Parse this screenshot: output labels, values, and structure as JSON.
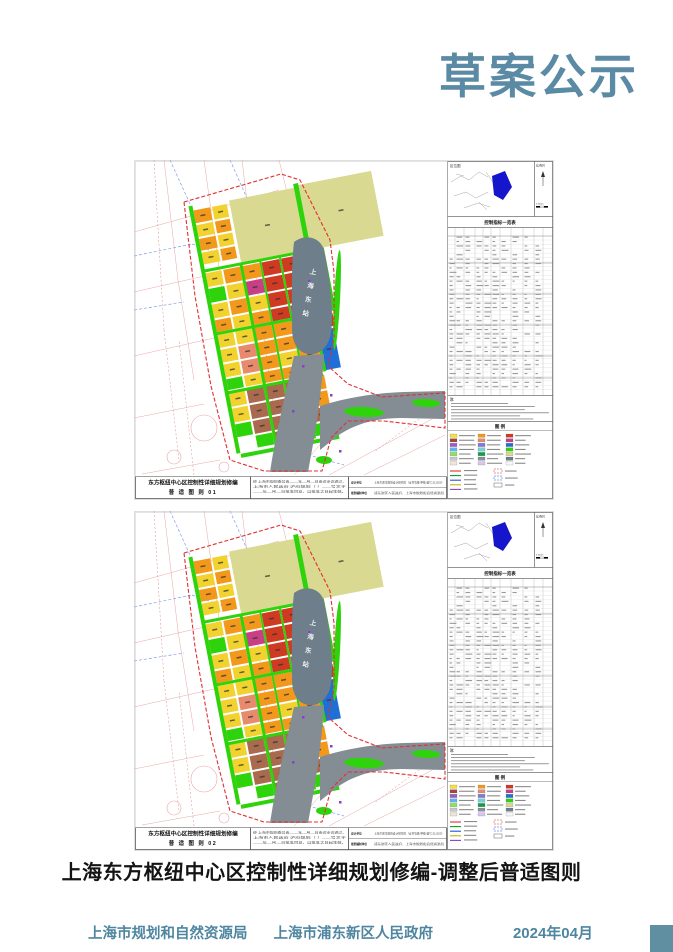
{
  "header": {
    "title": "草案公示",
    "accent_color": "#5b8ba4"
  },
  "caption": {
    "text": "上海东方枢纽中心区控制性详细规划修编-调整后普适图则"
  },
  "footer": {
    "agency_left": "上海市规划和自然资源局",
    "agency_right": "上海市浦东新区人民政府",
    "date": "2024年04月",
    "text_color": "#4e86a0",
    "square_color": "#5f8fa1"
  },
  "sheets": [
    {
      "number": "01"
    },
    {
      "number": "02"
    }
  ],
  "sheet": {
    "map_title": "东方枢纽中心区控制性详细规划修编",
    "sheet_type": "普 适 图 则",
    "station_label": "上海东站",
    "locator_label": "区位图",
    "scale_label": "比例尺",
    "scale_marks": "0  200m",
    "table_title": "控制指标一览表",
    "notes_label": "注:",
    "legend_title": "图 例",
    "approval_lines": [
      "经 上海市规划委员会____年__月__日会议审议通过，",
      "上海市人民政府 沪府规划〔 〕___号文于",
      "____年__月__日批准同意，自批准之日起生效。"
    ],
    "design_rows": [
      {
        "label": "设计单位",
        "text": "上海市城市规划设计研究院（证书等级:甲级 编号:211020）"
      },
      {
        "label": "规划编制单位",
        "text": "浦东新区人民政府、上海市规划和自然资源局"
      }
    ],
    "palette": {
      "Y": "#f2d22e",
      "O": "#f2991c",
      "R": "#cf3a23",
      "S": "#e88a6c",
      "B": "#a96a4d",
      "G": "#2fd30b",
      "L": "#d9d992",
      "U": "#1f6fd6",
      "M": "#c93f85",
      "station": "#6e7e8a",
      "corridor": "#848d94",
      "boundary": "#e03030",
      "bg_road": "#eaa5a5",
      "bg_water": "#7f9fe8",
      "locator_area": "#1515cc",
      "metro": "#8a3fc6"
    },
    "parcels": [
      [
        96,
        30,
        66,
        63,
        "L"
      ],
      [
        167,
        28,
        74,
        66,
        "L"
      ],
      [
        59,
        33,
        17,
        13,
        "O"
      ],
      [
        78,
        33,
        15,
        13,
        "Y"
      ],
      [
        59,
        48,
        17,
        12,
        "Y"
      ],
      [
        78,
        48,
        15,
        12,
        "O"
      ],
      [
        59,
        62,
        17,
        12,
        "O"
      ],
      [
        78,
        62,
        15,
        12,
        "Y"
      ],
      [
        59,
        76,
        17,
        12,
        "Y"
      ],
      [
        78,
        76,
        15,
        12,
        "O"
      ],
      [
        59,
        97,
        16,
        14,
        "Y"
      ],
      [
        77,
        97,
        17,
        14,
        "O"
      ],
      [
        96,
        97,
        18,
        14,
        "O"
      ],
      [
        116,
        97,
        18,
        14,
        "R"
      ],
      [
        136,
        97,
        20,
        14,
        "R"
      ],
      [
        158,
        97,
        18,
        14,
        "R"
      ],
      [
        59,
        113,
        16,
        14,
        "G"
      ],
      [
        77,
        113,
        17,
        14,
        "Y"
      ],
      [
        96,
        113,
        18,
        14,
        "M"
      ],
      [
        116,
        113,
        18,
        14,
        "R"
      ],
      [
        136,
        113,
        20,
        14,
        "R"
      ],
      [
        158,
        113,
        18,
        14,
        "R"
      ],
      [
        59,
        129,
        16,
        14,
        "Y"
      ],
      [
        77,
        129,
        17,
        14,
        "O"
      ],
      [
        96,
        129,
        18,
        14,
        "Y"
      ],
      [
        116,
        129,
        18,
        14,
        "R"
      ],
      [
        136,
        129,
        20,
        14,
        "R"
      ],
      [
        158,
        129,
        18,
        14,
        "R"
      ],
      [
        59,
        145,
        16,
        12,
        "O"
      ],
      [
        77,
        145,
        17,
        12,
        "Y"
      ],
      [
        96,
        145,
        18,
        12,
        "O"
      ],
      [
        116,
        145,
        18,
        12,
        "R"
      ],
      [
        136,
        145,
        20,
        12,
        "M"
      ],
      [
        59,
        160,
        16,
        13,
        "Y"
      ],
      [
        77,
        160,
        17,
        13,
        "Y"
      ],
      [
        96,
        160,
        18,
        13,
        "O"
      ],
      [
        116,
        160,
        18,
        13,
        "O"
      ],
      [
        136,
        160,
        20,
        13,
        "R"
      ],
      [
        158,
        160,
        18,
        13,
        "R"
      ],
      [
        59,
        175,
        16,
        13,
        "Y"
      ],
      [
        77,
        175,
        17,
        13,
        "S"
      ],
      [
        96,
        175,
        18,
        13,
        "O"
      ],
      [
        116,
        175,
        18,
        13,
        "O"
      ],
      [
        136,
        175,
        20,
        13,
        "O"
      ],
      [
        158,
        175,
        16,
        40,
        "U"
      ],
      [
        59,
        190,
        16,
        13,
        "Y"
      ],
      [
        77,
        190,
        17,
        13,
        "S"
      ],
      [
        96,
        190,
        18,
        13,
        "O"
      ],
      [
        116,
        190,
        18,
        13,
        "Y"
      ],
      [
        136,
        190,
        20,
        13,
        "O"
      ],
      [
        59,
        205,
        16,
        11,
        "G"
      ],
      [
        77,
        205,
        17,
        11,
        "Y"
      ],
      [
        96,
        205,
        18,
        11,
        "O"
      ],
      [
        116,
        205,
        18,
        11,
        "O"
      ],
      [
        136,
        205,
        20,
        11,
        "O"
      ],
      [
        59,
        219,
        16,
        14,
        "Y"
      ],
      [
        77,
        219,
        17,
        14,
        "B"
      ],
      [
        96,
        219,
        18,
        14,
        "B"
      ],
      [
        116,
        219,
        18,
        14,
        "B"
      ],
      [
        136,
        219,
        20,
        14,
        "O"
      ],
      [
        59,
        235,
        16,
        14,
        "Y"
      ],
      [
        77,
        235,
        17,
        14,
        "B"
      ],
      [
        96,
        235,
        18,
        14,
        "B"
      ],
      [
        116,
        235,
        18,
        14,
        "B"
      ],
      [
        136,
        235,
        20,
        14,
        "O"
      ],
      [
        59,
        251,
        16,
        13,
        "G"
      ],
      [
        77,
        251,
        17,
        13,
        "B"
      ],
      [
        96,
        251,
        18,
        13,
        "B"
      ],
      [
        116,
        251,
        18,
        13,
        "Y"
      ],
      [
        136,
        251,
        20,
        13,
        "B"
      ],
      [
        77,
        266,
        17,
        12,
        "G"
      ],
      [
        96,
        266,
        18,
        12,
        "B"
      ],
      [
        116,
        266,
        18,
        12,
        "G"
      ],
      [
        136,
        266,
        20,
        12,
        "G"
      ],
      [
        55,
        28,
        4,
        252,
        "G"
      ],
      [
        94,
        94,
        3,
        186,
        "G"
      ],
      [
        114,
        94,
        2,
        186,
        "G"
      ],
      [
        134,
        94,
        2,
        186,
        "G"
      ],
      [
        156,
        94,
        3,
        122,
        "G"
      ],
      [
        57,
        93,
        120,
        3,
        "G"
      ],
      [
        57,
        157,
        100,
        3,
        "G"
      ],
      [
        57,
        217,
        98,
        3,
        "G"
      ],
      [
        59,
        281,
        100,
        4,
        "G"
      ],
      [
        176,
        94,
        4,
        64,
        "G"
      ],
      [
        162,
        26,
        5,
        66,
        "G"
      ]
    ],
    "legend_colors": [
      "#f2e23a",
      "#f2991c",
      "#cf3a23",
      "#a84632",
      "#e88a6c",
      "#c93f85",
      "#9a5bc8",
      "#7b7bd8",
      "#1f6fd6",
      "#58b8e8",
      "#79cfd2",
      "#2fd30b",
      "#8fe05f",
      "#0f9e4e",
      "#d9d992",
      "#c9c9c9",
      "#8a9199",
      "#6e7e8a",
      "#efe7d6",
      "#d9c6ef",
      "#f7f7f7"
    ],
    "legend_line_colors": [
      "#e03030",
      "#00a020",
      "#2050e0",
      "#c8b400",
      "#8a3fc6"
    ]
  }
}
